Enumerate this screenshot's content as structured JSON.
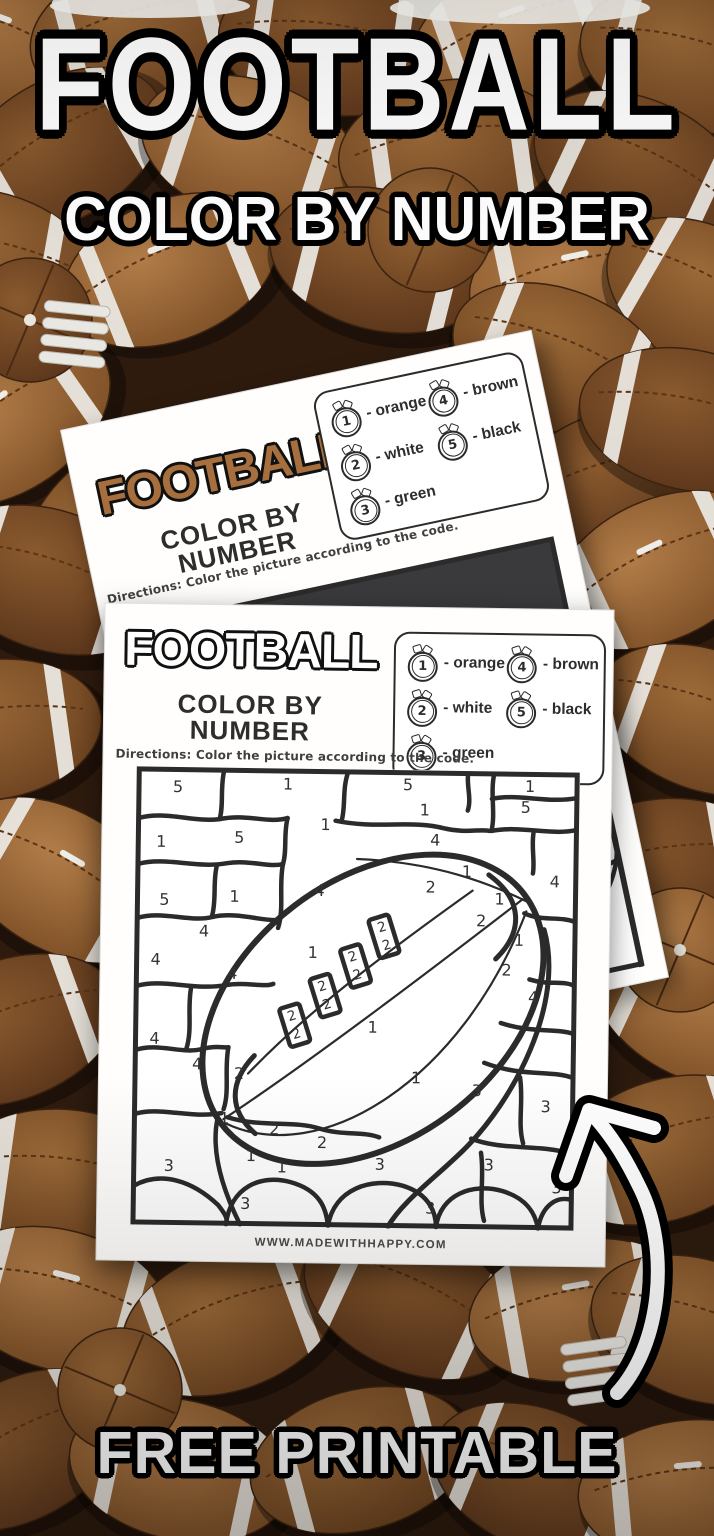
{
  "banner": {
    "title": "FOOTBALL",
    "subtitle": "COLOR BY NUMBER",
    "footer": "FREE PRINTABLE"
  },
  "back_sheet": {
    "title": "FOOTBALL",
    "subtitle": "COLOR BY NUMBER",
    "directions": "Directions: Color the picture according to the code.",
    "legend": {
      "items": [
        {
          "number": "1",
          "label": "- orange"
        },
        {
          "number": "2",
          "label": "- white"
        },
        {
          "number": "3",
          "label": "- green"
        },
        {
          "number": "4",
          "label": "- brown"
        },
        {
          "number": "5",
          "label": "- black"
        }
      ]
    },
    "picture_numbers": [
      {
        "v": "5",
        "x": 62,
        "y": 28,
        "fill": "#55545a"
      },
      {
        "v": "1",
        "x": 150,
        "y": 56
      },
      {
        "v": "1",
        "x": 290,
        "y": 120
      },
      {
        "v": "1",
        "x": 75,
        "y": 164
      },
      {
        "v": "4",
        "x": 338,
        "y": 232,
        "fill": "#4a3a28"
      },
      {
        "v": "4",
        "x": 420,
        "y": 182,
        "fill": "#4a3a28"
      }
    ]
  },
  "front_sheet": {
    "title": "FOOTBALL",
    "subtitle": "COLOR BY NUMBER",
    "directions": "Directions: Color the picture according to the code.",
    "url": "WWW.MADEWITHHAPPY.COM",
    "legend": {
      "items": [
        {
          "number": "1",
          "label": "- orange"
        },
        {
          "number": "2",
          "label": "- white"
        },
        {
          "number": "3",
          "label": "- green"
        },
        {
          "number": "4",
          "label": "- brown"
        },
        {
          "number": "5",
          "label": "- black"
        }
      ]
    },
    "picture_numbers": [
      {
        "v": "5",
        "x": 42,
        "y": 20
      },
      {
        "v": "1",
        "x": 152,
        "y": 16
      },
      {
        "v": "5",
        "x": 272,
        "y": 15
      },
      {
        "v": "1",
        "x": 394,
        "y": 15
      },
      {
        "v": "1",
        "x": 289,
        "y": 40
      },
      {
        "v": "5",
        "x": 390,
        "y": 36
      },
      {
        "v": "1",
        "x": 26,
        "y": 75
      },
      {
        "v": "5",
        "x": 104,
        "y": 70
      },
      {
        "v": "1",
        "x": 190,
        "y": 56
      },
      {
        "v": "4",
        "x": 300,
        "y": 70
      },
      {
        "v": "1",
        "x": 332,
        "y": 101
      },
      {
        "v": "4",
        "x": 420,
        "y": 110
      },
      {
        "v": "2",
        "x": 296,
        "y": 117
      },
      {
        "v": "5",
        "x": 30,
        "y": 133
      },
      {
        "v": "1",
        "x": 100,
        "y": 129
      },
      {
        "v": "4",
        "x": 185,
        "y": 122
      },
      {
        "v": "1",
        "x": 365,
        "y": 128
      },
      {
        "v": "2",
        "x": 347,
        "y": 150
      },
      {
        "v": "4",
        "x": 70,
        "y": 164
      },
      {
        "v": "1",
        "x": 385,
        "y": 169
      },
      {
        "v": "4",
        "x": 22,
        "y": 193
      },
      {
        "v": "1",
        "x": 179,
        "y": 184
      },
      {
        "v": "2",
        "x": 373,
        "y": 199
      },
      {
        "v": "4",
        "x": 99,
        "y": 206
      },
      {
        "v": "4",
        "x": 400,
        "y": 226
      },
      {
        "v": "1",
        "x": 240,
        "y": 258
      },
      {
        "v": "4",
        "x": 22,
        "y": 272
      },
      {
        "v": "4",
        "x": 65,
        "y": 297
      },
      {
        "v": "2",
        "x": 107,
        "y": 306
      },
      {
        "v": "1",
        "x": 284,
        "y": 308
      },
      {
        "v": "3",
        "x": 345,
        "y": 320
      },
      {
        "v": "3",
        "x": 414,
        "y": 335
      },
      {
        "v": "1",
        "x": 93,
        "y": 351
      },
      {
        "v": "2",
        "x": 143,
        "y": 361
      },
      {
        "v": "2",
        "x": 191,
        "y": 374
      },
      {
        "v": "1",
        "x": 120,
        "y": 388
      },
      {
        "v": "1",
        "x": 151,
        "y": 399
      },
      {
        "v": "3",
        "x": 38,
        "y": 399
      },
      {
        "v": "3",
        "x": 249,
        "y": 395
      },
      {
        "v": "3",
        "x": 358,
        "y": 394
      },
      {
        "v": "3",
        "x": 426,
        "y": 416
      },
      {
        "v": "3",
        "x": 115,
        "y": 436
      },
      {
        "v": "3",
        "x": 300,
        "y": 438
      }
    ],
    "lace_numbers": [
      {
        "v": "2",
        "x": 248,
        "y": 158,
        "r": -18
      },
      {
        "v": "2",
        "x": 253,
        "y": 176,
        "r": -18
      },
      {
        "v": "2",
        "x": 219,
        "y": 188,
        "r": -18
      },
      {
        "v": "2",
        "x": 224,
        "y": 206,
        "r": -18
      },
      {
        "v": "2",
        "x": 189,
        "y": 218,
        "r": -18
      },
      {
        "v": "2",
        "x": 194,
        "y": 236,
        "r": -18
      },
      {
        "v": "2",
        "x": 159,
        "y": 248,
        "r": -18
      },
      {
        "v": "2",
        "x": 164,
        "y": 266,
        "r": -18
      }
    ]
  },
  "colors": {
    "outline_black": "#000000",
    "paper_white": "#fffefc",
    "back_title_brown": "#a66f3d",
    "region_dark": "#3a393b",
    "region_cream": "#f2ead6",
    "region_brown": "#8a5a30",
    "region_orange": "#e8962e",
    "region_green": "#3fa03c",
    "football_brown": "#9a6636",
    "stripe_white": "#eceae4"
  }
}
